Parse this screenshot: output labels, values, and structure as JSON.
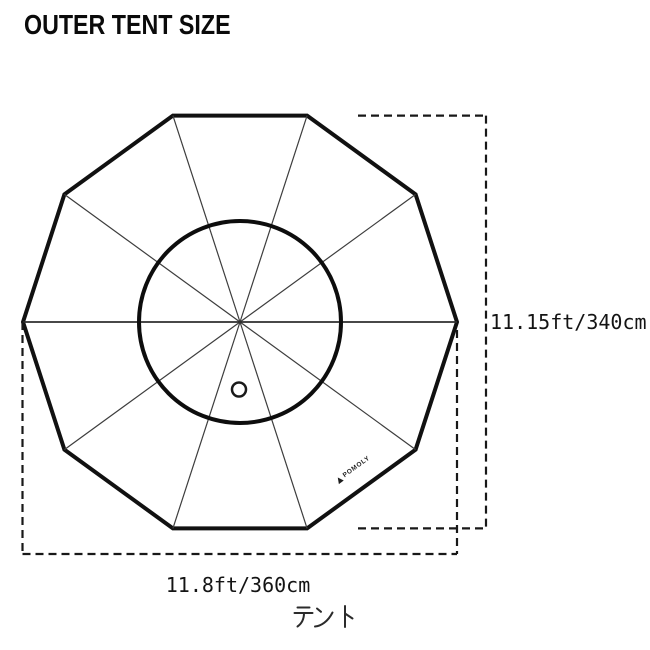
{
  "header": {
    "title": "OUTER TENT SIZE"
  },
  "diagram": {
    "name": "outer-tent-top-view",
    "shape": "regular-decagon",
    "dimensions": {
      "height_label": "11.15ft/340cm",
      "width_label": "11.8ft/360cm"
    },
    "brand": {
      "icon": "triangle-icon",
      "label": "POMOLY"
    },
    "caption": {
      "label": "テント"
    },
    "colors": {
      "background": "#ffffff",
      "outline": "#111111",
      "spokes": "#3d3d3d",
      "dashed_dim": "#181818",
      "text": "#141414"
    }
  }
}
